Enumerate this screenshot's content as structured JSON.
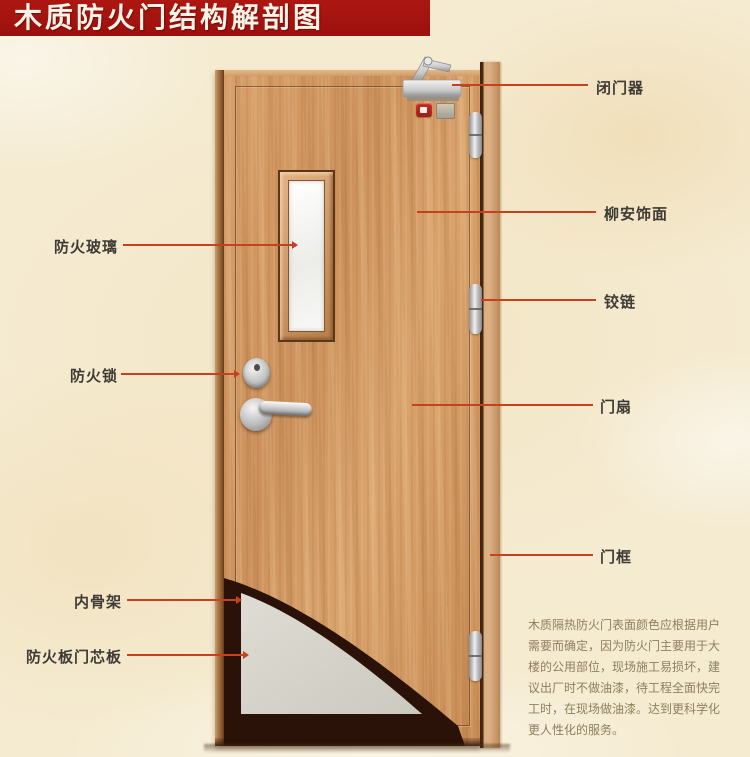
{
  "title": "木质防火门结构解剖图",
  "annotations": {
    "left": [
      {
        "id": "fire-glass",
        "text": "防火玻璃"
      },
      {
        "id": "fire-lock",
        "text": "防火锁"
      },
      {
        "id": "inner-skeleton",
        "text": "内骨架"
      },
      {
        "id": "core-board",
        "text": "防火板门芯板"
      }
    ],
    "right": [
      {
        "id": "door-closer",
        "text": "闭门器"
      },
      {
        "id": "lauan-veneer",
        "text": "柳安饰面"
      },
      {
        "id": "hinge",
        "text": "铰链"
      },
      {
        "id": "door-leaf",
        "text": "门扇"
      },
      {
        "id": "door-frame",
        "text": "门框"
      }
    ]
  },
  "description": {
    "lines": [
      "木质隔热防火门表面颜色应根据用户",
      "需要而确定，因为防火门主要用于大",
      "楼的公用部位，现场施工易损坏，建",
      "议出厂时不做油漆，待工程全面快完",
      "工时，在现场做油漆。达到更科学化",
      "更人性化的服务。"
    ]
  },
  "colors": {
    "banner": "#a31311",
    "banner_text": "#faf4e8",
    "callout_line": "#c8411e",
    "label_text": "#3e3b35",
    "wood": "#d49a66",
    "frame_wood": "#d9ae80",
    "background": "#f5ebd1",
    "core_board": "#d7d5cc",
    "skeleton": "#2a1208"
  }
}
